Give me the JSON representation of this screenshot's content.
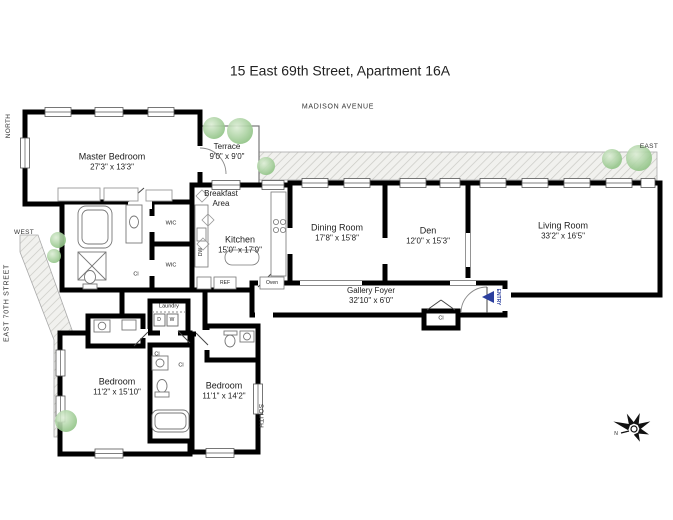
{
  "title": "15 East 69th Street, Apartment 16A",
  "streets": {
    "top": "MADISON AVENUE",
    "left": "EAST 70TH STREET",
    "north": "NORTH",
    "west": "WEST",
    "east": "EAST",
    "south": "SOUTH"
  },
  "rooms": {
    "master_bedroom": {
      "name": "Master Bedroom",
      "dims": "27'3\" x 13'3\""
    },
    "terrace": {
      "name": "Terrace",
      "dims": "9'0\" x 9'0\""
    },
    "breakfast_area": {
      "line1": "Breakfast",
      "line2": "Area"
    },
    "kitchen": {
      "name": "Kitchen",
      "dims": "15'0\" x 17'9\""
    },
    "dining_room": {
      "name": "Dining Room",
      "dims": "17'8\" x 15'8\""
    },
    "den": {
      "name": "Den",
      "dims": "12'0\" x 15'3\""
    },
    "living_room": {
      "name": "Living Room",
      "dims": "33'2\" x 16'5\""
    },
    "gallery_foyer": {
      "name": "Gallery Foyer",
      "dims": "32'10\" x 6'0\""
    },
    "laundry": {
      "name": "Laundry"
    },
    "bedroom_2": {
      "name": "Bedroom",
      "dims": "11'2\" x 15'10\""
    },
    "bedroom_3": {
      "name": "Bedroom",
      "dims": "11'1\" x 14'2\""
    }
  },
  "annotations": {
    "wic": "WIC",
    "closet": "Cl",
    "entry": "ENTRY",
    "washer": "W",
    "dryer": "D",
    "dishwasher": "DW",
    "refrigerator": "REF",
    "oven": "Oven",
    "compass_n": "N"
  },
  "colors": {
    "wall": "#000000",
    "entry_arrow": "#2b3f9e",
    "tree": "#9ccf92",
    "hatch": "#c9c9c4"
  }
}
